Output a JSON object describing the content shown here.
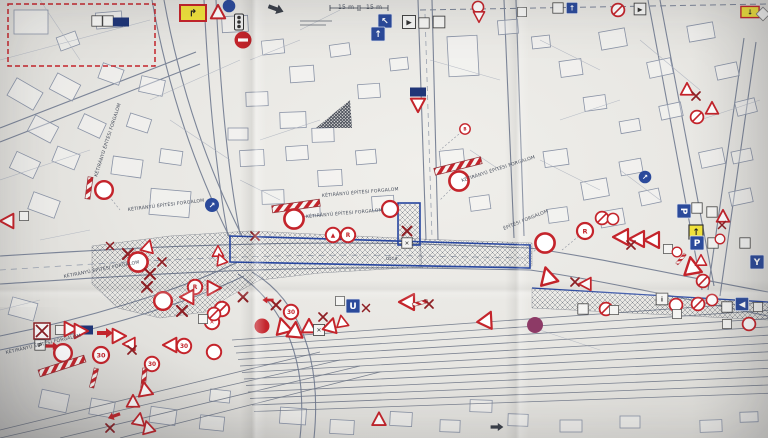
{
  "document": {
    "kind_label": "photographed construction traffic-control plan",
    "dimension_left": "15 m",
    "dimension_right": "15 m"
  },
  "colors": {
    "sign_red": "#c4242b",
    "handwriting_dark_red": "#8e1f24",
    "sign_blue": "#2b4a9b",
    "sign_navy": "#1f3577",
    "sign_yellow": "#f0e23c",
    "zone_outline_blue": "#2746a0",
    "dashed_area_red": "#c4242b",
    "no_stopping_purple": "#8d3a66",
    "paper": "#e9e8e4",
    "print_gray": "#8a93a6"
  },
  "labels": [
    {
      "text": "15 m",
      "x": 338,
      "y": 9,
      "rot": 0,
      "size": 6
    },
    {
      "text": "15 m",
      "x": 366,
      "y": 9,
      "rot": 0,
      "size": 6
    },
    {
      "text": "KÉTIRÁNYÚ ÉPÍTÉSI FORGALOM",
      "x": 97,
      "y": 177,
      "rot": -72,
      "size": 4.6
    },
    {
      "text": "KÉTIRÁNYÚ ÉPÍTÉSI FORGALOM",
      "x": 128,
      "y": 211,
      "rot": -7,
      "size": 4.6
    },
    {
      "text": "KÉTIRÁNYÚ ÉPÍTÉSI FORGALOM",
      "x": 64,
      "y": 278,
      "rot": -11,
      "size": 4.6
    },
    {
      "text": "KÉTIRÁNYÚ ÉPÍTÉSI FORGALOM",
      "x": 322,
      "y": 197,
      "rot": -5,
      "size": 4.6
    },
    {
      "text": "KÉTIRÁNYÚ ÉPÍTÉSI FORGALOM",
      "x": 306,
      "y": 218,
      "rot": -5,
      "size": 4.6
    },
    {
      "text": "KÉTIRÁNYÚ ÉPÍTÉSI FORGALOM",
      "x": 462,
      "y": 182,
      "rot": -18,
      "size": 4.6
    },
    {
      "text": "KÉTIRÁNYÚ ÉPÍTÉSI FORGALOM",
      "x": 6,
      "y": 354,
      "rot": -13,
      "size": 4.6
    },
    {
      "text": "ÉPÍTÉSI FORGALOM",
      "x": 504,
      "y": 230,
      "rot": -22,
      "size": 4.6
    },
    {
      "text": "utca",
      "x": 386,
      "y": 260,
      "rot": -2,
      "size": 5
    }
  ],
  "signs": [
    {
      "t": "whitesq",
      "x": 97,
      "y": 21,
      "s": 0.8
    },
    {
      "t": "whitesq",
      "x": 108,
      "y": 21,
      "s": 0.8
    },
    {
      "t": "bluerect",
      "x": 121,
      "y": 22
    },
    {
      "t": "ydetour",
      "x": 193,
      "y": 13,
      "g": "↱"
    },
    {
      "t": "tri",
      "x": 218,
      "y": 13,
      "s": 0.9
    },
    {
      "t": "dotblue",
      "x": 229,
      "y": 6,
      "s": 0.9
    },
    {
      "t": "signal",
      "x": 239,
      "y": 22
    },
    {
      "t": "noentry",
      "x": 243,
      "y": 40
    },
    {
      "t": "arrowdark",
      "x": 276,
      "y": 9,
      "r": 20
    },
    {
      "t": "bluesq",
      "x": 385,
      "y": 21,
      "g": "↖"
    },
    {
      "t": "bluesq",
      "x": 378,
      "y": 34,
      "g": "↑"
    },
    {
      "t": "whitesq",
      "x": 409,
      "y": 22,
      "g": "▶"
    },
    {
      "t": "whitesq",
      "x": 424,
      "y": 23,
      "s": 0.8
    },
    {
      "t": "whitesq",
      "x": 439,
      "y": 22,
      "s": 0.9
    },
    {
      "t": "ring",
      "x": 478,
      "y": 7,
      "s": 0.7
    },
    {
      "t": "yield",
      "x": 479,
      "y": 16,
      "s": 0.7
    },
    {
      "t": "whitesq",
      "x": 522,
      "y": 12,
      "s": 0.7
    },
    {
      "t": "whitesq",
      "x": 558,
      "y": 8,
      "s": 0.8
    },
    {
      "t": "bluesq",
      "x": 572,
      "y": 8,
      "s": 0.8,
      "g": "↑"
    },
    {
      "t": "ringslash",
      "x": 618,
      "y": 10,
      "s": 0.8
    },
    {
      "t": "whitesq",
      "x": 640,
      "y": 9,
      "g": "▶",
      "s": 0.9
    },
    {
      "t": "ydetour",
      "x": 750,
      "y": 12,
      "s": 0.7,
      "g": "↓"
    },
    {
      "t": "diamond",
      "x": 763,
      "y": 14,
      "s": 0.8
    },
    {
      "t": "bluerect",
      "x": 418,
      "y": 92
    },
    {
      "t": "yield",
      "x": 418,
      "y": 104,
      "s": 0.9
    },
    {
      "t": "ring",
      "x": 465,
      "y": 129,
      "s": 0.65,
      "g": "B"
    },
    {
      "t": "dotblue",
      "x": 212,
      "y": 205,
      "g": "↗"
    },
    {
      "t": "dotblue",
      "x": 645,
      "y": 177,
      "s": 0.9,
      "g": "↗"
    },
    {
      "t": "tri",
      "x": 687,
      "y": 90,
      "s": 0.8
    },
    {
      "t": "xmark",
      "x": 696,
      "y": 96,
      "s": 0.8
    },
    {
      "t": "ringslash",
      "x": 697,
      "y": 117,
      "s": 0.8
    },
    {
      "t": "tri",
      "x": 712,
      "y": 109,
      "s": 0.8
    },
    {
      "t": "pole",
      "x": 89,
      "y": 188,
      "r": 8
    },
    {
      "t": "ring",
      "x": 104,
      "y": 190,
      "s": 1.1
    },
    {
      "t": "tri",
      "x": 8,
      "y": 221,
      "r": -90,
      "s": 0.9
    },
    {
      "t": "whitesq",
      "x": 24,
      "y": 216,
      "s": 0.7
    },
    {
      "t": "barrier",
      "x": 296,
      "y": 206,
      "r": -8
    },
    {
      "t": "ring",
      "x": 294,
      "y": 219,
      "s": 1.2
    },
    {
      "t": "barrier",
      "x": 458,
      "y": 166,
      "r": -14
    },
    {
      "t": "ring",
      "x": 459,
      "y": 181,
      "s": 1.2
    },
    {
      "t": "ring",
      "x": 390,
      "y": 209
    },
    {
      "t": "ring",
      "x": 333,
      "y": 235,
      "s": 0.9,
      "g": "▲"
    },
    {
      "t": "ring",
      "x": 348,
      "y": 235,
      "s": 0.9,
      "g": "R"
    },
    {
      "t": "xmark",
      "x": 407,
      "y": 231,
      "s": 0.9
    },
    {
      "t": "whitesq",
      "x": 407,
      "y": 243,
      "s": 0.8,
      "g": "✕"
    },
    {
      "t": "bluerect",
      "x": 85,
      "y": 330
    },
    {
      "t": "arrow",
      "x": 105,
      "y": 333
    },
    {
      "t": "tri",
      "x": 118,
      "y": 336,
      "r": 90,
      "s": 0.9
    },
    {
      "t": "xmark",
      "x": 110,
      "y": 246,
      "s": 0.7
    },
    {
      "t": "tri",
      "x": 148,
      "y": 247,
      "s": 0.8,
      "r": 15
    },
    {
      "t": "xmark",
      "x": 128,
      "y": 254
    },
    {
      "t": "ring",
      "x": 138,
      "y": 262,
      "s": 1.2
    },
    {
      "t": "xmark",
      "x": 162,
      "y": 262,
      "s": 0.8
    },
    {
      "t": "xmark",
      "x": 150,
      "y": 274
    },
    {
      "t": "xmark",
      "x": 147,
      "y": 287
    },
    {
      "t": "ring",
      "x": 163,
      "y": 301,
      "s": 1.1
    },
    {
      "t": "ring",
      "x": 195,
      "y": 287,
      "s": 0.9,
      "g": "R"
    },
    {
      "t": "tri",
      "x": 213,
      "y": 288,
      "r": 90,
      "s": 0.9
    },
    {
      "t": "tri",
      "x": 188,
      "y": 297,
      "r": -90,
      "s": 0.9
    },
    {
      "t": "xmark",
      "x": 182,
      "y": 311
    },
    {
      "t": "ringslash",
      "x": 222,
      "y": 309,
      "s": 0.9
    },
    {
      "t": "ring",
      "x": 212,
      "y": 322,
      "s": 0.9,
      "g": "✕"
    },
    {
      "t": "tri",
      "x": 218,
      "y": 252,
      "s": 0.7
    },
    {
      "t": "tri",
      "x": 221,
      "y": 260,
      "s": 0.7,
      "r": -20
    },
    {
      "t": "xmark",
      "x": 255,
      "y": 236,
      "s": 0.8
    },
    {
      "t": "xmark",
      "x": 243,
      "y": 297,
      "s": 0.9
    },
    {
      "t": "dotred",
      "x": 262,
      "y": 326
    },
    {
      "t": "ringslash",
      "x": 214,
      "y": 314,
      "s": 0.8
    },
    {
      "t": "whitesq",
      "x": 203,
      "y": 319,
      "s": 0.7
    },
    {
      "t": "boxx",
      "x": 42,
      "y": 331
    },
    {
      "t": "whitesq",
      "x": 60,
      "y": 330,
      "s": 0.7
    },
    {
      "t": "tri",
      "x": 70,
      "y": 329,
      "r": 90,
      "s": 0.9
    },
    {
      "t": "tri",
      "x": 80,
      "y": 331,
      "r": 90,
      "s": 0.9
    },
    {
      "t": "whitesq",
      "x": 40,
      "y": 345,
      "g": "P",
      "s": 0.8
    },
    {
      "t": "arrow",
      "x": 52,
      "y": 346,
      "s": 0.8
    },
    {
      "t": "ring",
      "x": 63,
      "y": 353,
      "s": 1.1
    },
    {
      "t": "ring",
      "x": 101,
      "y": 355,
      "g": "30"
    },
    {
      "t": "barrier",
      "x": 62,
      "y": 366,
      "r": -18
    },
    {
      "t": "pole",
      "x": 94,
      "y": 378,
      "r": 14,
      "s": 0.9
    },
    {
      "t": "tri",
      "x": 130,
      "y": 344,
      "r": -90,
      "s": 0.8
    },
    {
      "t": "xmark",
      "x": 132,
      "y": 350,
      "s": 0.8
    },
    {
      "t": "ring",
      "x": 152,
      "y": 364,
      "s": 0.9,
      "g": "30"
    },
    {
      "t": "pole",
      "x": 144,
      "y": 378,
      "r": 6,
      "s": 0.9
    },
    {
      "t": "tri",
      "x": 145,
      "y": 390,
      "s": 0.9,
      "r": -10
    },
    {
      "t": "tri",
      "x": 133,
      "y": 402,
      "s": 0.8
    },
    {
      "t": "arrow",
      "x": 114,
      "y": 416,
      "r": 160,
      "s": 0.8
    },
    {
      "t": "tri",
      "x": 139,
      "y": 420,
      "s": 0.8,
      "r": 10
    },
    {
      "t": "tri",
      "x": 148,
      "y": 428,
      "s": 0.8,
      "r": -15
    },
    {
      "t": "xmark",
      "x": 110,
      "y": 428,
      "s": 0.8
    },
    {
      "t": "tri",
      "x": 171,
      "y": 345,
      "r": -90,
      "s": 0.9
    },
    {
      "t": "ring",
      "x": 184,
      "y": 346,
      "s": 0.9,
      "g": "30"
    },
    {
      "t": "ring",
      "x": 214,
      "y": 352,
      "s": 0.9
    },
    {
      "t": "xmark",
      "x": 276,
      "y": 305,
      "s": 0.9
    },
    {
      "t": "arrow",
      "x": 268,
      "y": 300,
      "r": 180,
      "s": 0.7
    },
    {
      "t": "ring",
      "x": 291,
      "y": 312,
      "s": 0.9,
      "g": "30"
    },
    {
      "t": "tri",
      "x": 283,
      "y": 327,
      "r": -15
    },
    {
      "t": "tri",
      "x": 295,
      "y": 331,
      "r": 5
    },
    {
      "t": "tri",
      "x": 309,
      "y": 327,
      "s": 0.9
    },
    {
      "t": "whitesq",
      "x": 319,
      "y": 330,
      "s": 0.85,
      "g": "✕"
    },
    {
      "t": "tri",
      "x": 331,
      "y": 326,
      "r": 15,
      "s": 0.9
    },
    {
      "t": "xmark",
      "x": 323,
      "y": 317,
      "s": 0.8
    },
    {
      "t": "tri",
      "x": 342,
      "y": 322,
      "s": 0.75,
      "r": -10
    },
    {
      "t": "whitesq",
      "x": 340,
      "y": 301,
      "s": 0.7
    },
    {
      "t": "bluesq",
      "x": 353,
      "y": 306,
      "g": "U"
    },
    {
      "t": "xmark",
      "x": 366,
      "y": 308,
      "s": 0.7
    },
    {
      "t": "tri",
      "x": 379,
      "y": 420,
      "s": 0.85
    },
    {
      "t": "tri",
      "x": 408,
      "y": 302,
      "r": -90
    },
    {
      "t": "pole",
      "x": 420,
      "y": 303,
      "r": 75,
      "s": 0.7
    },
    {
      "t": "xmark",
      "x": 429,
      "y": 304,
      "s": 0.8
    },
    {
      "t": "tri",
      "x": 487,
      "y": 320,
      "r": 25
    },
    {
      "t": "arrowdark",
      "x": 497,
      "y": 427,
      "s": 0.8
    },
    {
      "t": "dotpurple",
      "x": 535,
      "y": 325
    },
    {
      "t": "whitesq",
      "x": 583,
      "y": 309,
      "s": 0.8
    },
    {
      "t": "ringslash",
      "x": 606,
      "y": 309,
      "s": 0.8
    },
    {
      "t": "whitesq",
      "x": 614,
      "y": 310,
      "s": 0.7
    },
    {
      "t": "whitesq",
      "x": 662,
      "y": 299,
      "s": 0.9,
      "g": "i"
    },
    {
      "t": "ring",
      "x": 676,
      "y": 305,
      "s": 0.8
    },
    {
      "t": "whitesq",
      "x": 677,
      "y": 314,
      "s": 0.7
    },
    {
      "t": "ringslash",
      "x": 698,
      "y": 304,
      "s": 0.8
    },
    {
      "t": "ring",
      "x": 712,
      "y": 300,
      "s": 0.7
    },
    {
      "t": "whitesq",
      "x": 727,
      "y": 307,
      "s": 0.8
    },
    {
      "t": "bluesq",
      "x": 742,
      "y": 304,
      "g": "◀",
      "s": 0.95
    },
    {
      "t": "whitesq",
      "x": 758,
      "y": 307,
      "s": 0.7
    },
    {
      "t": "ring",
      "x": 749,
      "y": 324,
      "s": 0.8
    },
    {
      "t": "whitesq",
      "x": 727,
      "y": 324,
      "s": 0.7
    },
    {
      "t": "ring",
      "x": 585,
      "y": 231,
      "g": "R"
    },
    {
      "t": "ring",
      "x": 545,
      "y": 243,
      "s": 1.2
    },
    {
      "t": "tri",
      "x": 622,
      "y": 237,
      "r": -90
    },
    {
      "t": "tri",
      "x": 638,
      "y": 239,
      "r": -90
    },
    {
      "t": "tri",
      "x": 653,
      "y": 240,
      "r": -90
    },
    {
      "t": "xmark",
      "x": 631,
      "y": 245,
      "s": 0.8
    },
    {
      "t": "ringslash",
      "x": 602,
      "y": 218,
      "s": 0.8
    },
    {
      "t": "ring",
      "x": 613,
      "y": 219,
      "s": 0.7
    },
    {
      "t": "tri",
      "x": 548,
      "y": 277,
      "r": -15,
      "s": 1.1
    },
    {
      "t": "xmark",
      "x": 575,
      "y": 282,
      "s": 0.8
    },
    {
      "t": "tri",
      "x": 586,
      "y": 284,
      "r": -90,
      "s": 0.8
    },
    {
      "t": "bluesq",
      "x": 684,
      "y": 211,
      "g": "P",
      "r": 90
    },
    {
      "t": "whitesq",
      "x": 697,
      "y": 208,
      "s": 0.8
    },
    {
      "t": "whitesq",
      "x": 712,
      "y": 212,
      "s": 0.8
    },
    {
      "t": "tri",
      "x": 723,
      "y": 217,
      "s": 0.8
    },
    {
      "t": "xmark",
      "x": 722,
      "y": 225,
      "s": 0.7
    },
    {
      "t": "yellowsq",
      "x": 696,
      "y": 232,
      "g": "↑"
    },
    {
      "t": "bluesq",
      "x": 697,
      "y": 243,
      "g": "P"
    },
    {
      "t": "whitesq",
      "x": 713,
      "y": 243,
      "s": 0.8
    },
    {
      "t": "ring",
      "x": 720,
      "y": 239,
      "s": 0.6
    },
    {
      "t": "pole",
      "x": 681,
      "y": 259,
      "r": 40,
      "s": 0.6
    },
    {
      "t": "tri",
      "x": 692,
      "y": 267,
      "r": -10,
      "s": 1.1
    },
    {
      "t": "tri",
      "x": 701,
      "y": 261,
      "s": 0.7
    },
    {
      "t": "whitesq",
      "x": 745,
      "y": 243,
      "s": 0.8
    },
    {
      "t": "bluesq",
      "x": 757,
      "y": 262,
      "g": "Y"
    },
    {
      "t": "ringslash",
      "x": 703,
      "y": 281,
      "s": 0.8
    },
    {
      "t": "whitesq",
      "x": 668,
      "y": 249,
      "s": 0.7
    },
    {
      "t": "ring",
      "x": 677,
      "y": 252,
      "s": 0.6
    }
  ]
}
